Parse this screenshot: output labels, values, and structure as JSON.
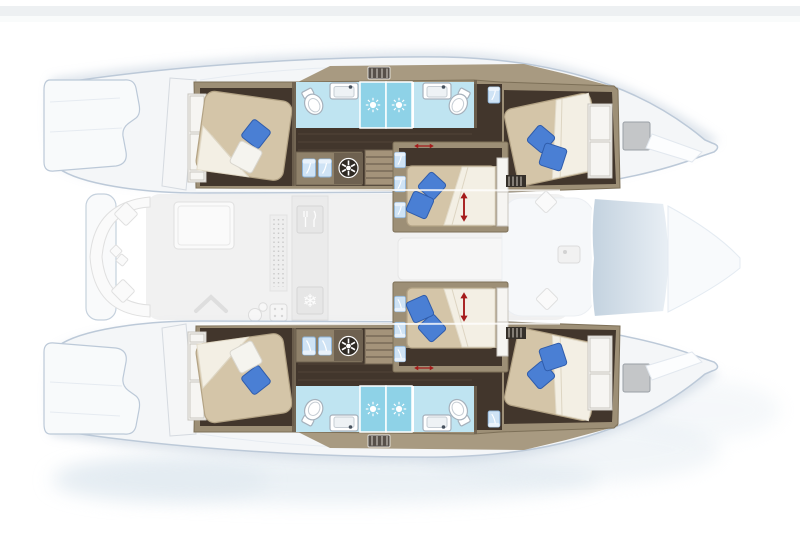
{
  "scene": {
    "subject": "catamaran yacht interior floor plan",
    "view": "top-down cutaway, bow pointing right, deck level shown faded",
    "hulls": 2,
    "double_beds": 6,
    "toilets": 4,
    "washbasins": 4,
    "showers": 4,
    "companionway_stairs": 2,
    "washing_machines": 2
  },
  "glyphs": {
    "snowflake": "❄"
  },
  "icons": {
    "shower": "sun-rays-icon",
    "fridge": "snowflake-icon",
    "galley": "fork-and-knife-icon",
    "laundry": "washing-machine-drum-icon",
    "bed_convertible": "red-double-arrow-icon",
    "deck_hatch": "gray-hatch-rectangle"
  },
  "colors": {
    "background": "#ffffff",
    "hull_fill": "#f4f6f8",
    "hull_outline": "#bcc9d8",
    "shadow_fog": "#dce6ee",
    "deck_band": "#a89a81",
    "wall": "#9d8f76",
    "wall_dark": "#6f6250",
    "floor_dark": "#42362c",
    "floor_plank": "#5a4a3c",
    "bed": "#d4c5a8",
    "bed_stroke": "#b3a385",
    "duvet": "#f3efe4",
    "pillow_blue": "#4a7fd4",
    "pillow_blue_dark": "#2f5cab",
    "pillow_white": "#f5f4ef",
    "bathroom_floor": "#bfe4f1",
    "shower_floor": "#8ed2e7",
    "fixture_white": "#ffffff",
    "fixture_stroke": "#a6b1bc",
    "locker_blue": "#cfe3f5",
    "locker_stroke": "#8fb4d8",
    "stairs": "#a4937a",
    "hatch_gray": "#c4c6c8",
    "arrow_red": "#a51b1b",
    "appliance_dark": "#2f2a24",
    "salon_fill": "#f0f0f0",
    "furniture_white": "#fafafa",
    "furniture_stroke": "#e0e0e0",
    "icon_white": "#ffffff"
  },
  "layout": {
    "per_hull_cabins": [
      {
        "name": "aft-cabin",
        "features": [
          "double-bed",
          "wardrobe",
          "blue-pillow",
          "white-pillow"
        ]
      },
      {
        "name": "aft-bathroom",
        "features": [
          "toilet",
          "washbasin",
          "shower-with-sun-floor"
        ]
      },
      {
        "name": "mid-bathroom",
        "features": [
          "toilet",
          "washbasin",
          "shower-with-sun-floor"
        ]
      },
      {
        "name": "mid-cabin",
        "features": [
          "double-bed",
          "two-blue-pillows",
          "red-adjust-arrows",
          "lockers",
          "closet"
        ]
      },
      {
        "name": "forward-cabin",
        "features": [
          "double-bed",
          "two-pillows",
          "closet",
          "vent-grille"
        ]
      }
    ],
    "per_hull_extras": [
      "washing-machine",
      "companionway-stairs",
      "locker-tiles",
      "deck-grille",
      "bow-hatch"
    ],
    "deck_level_faded": [
      "swim-platforms",
      "cockpit-bench-with-cushions",
      "cockpit-table",
      "galley-cutlery-station",
      "fridge-snowflake-station",
      "galley-sink-and-cooktop",
      "salon-floor",
      "forward-lounge-cushions",
      "coachroof-glass-panel",
      "foredeck"
    ]
  }
}
